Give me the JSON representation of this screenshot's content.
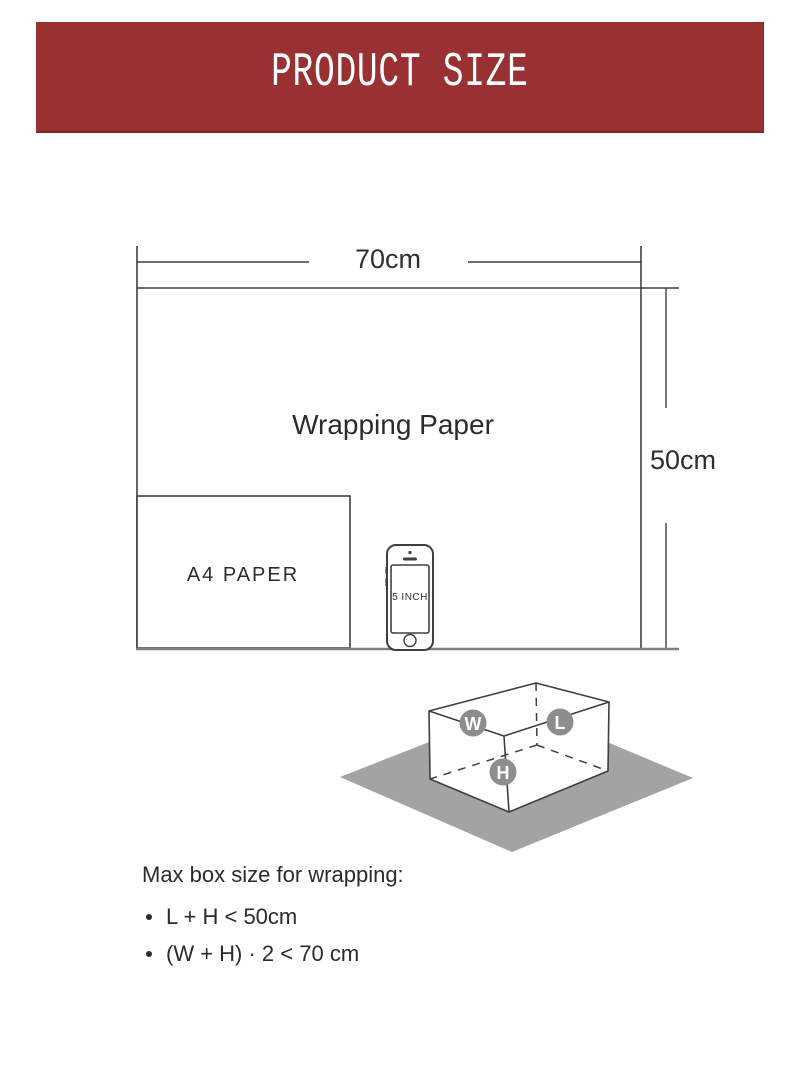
{
  "banner": {
    "title": "PRODUCT SIZE",
    "bg_color": "#993132",
    "text_color": "#ffffff"
  },
  "paper_diagram": {
    "paper_label": "Wrapping Paper",
    "width_label": "70cm",
    "height_label": "50cm",
    "a4_label": "A4 PAPER",
    "phone_label": "5 INCH",
    "line_color": "#3f3f3f",
    "baseline_color": "#7f7f7f"
  },
  "box_diagram": {
    "width_badge": "W",
    "length_badge": "L",
    "height_badge": "H",
    "badge_color": "#8d8d8d",
    "ground_color": "#a3a3a3"
  },
  "max_size": {
    "heading": "Max box size for wrapping:",
    "rules": [
      "L + H < 50cm",
      "(W + H) · 2 < 70 cm"
    ]
  }
}
